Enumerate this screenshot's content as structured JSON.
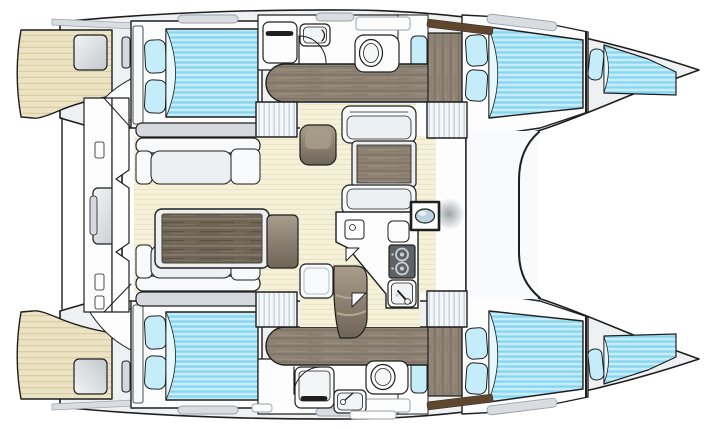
{
  "meta": {
    "type": "catamaran-floor-plan",
    "view": "top-down interior layout, bows to the right",
    "label": "Catamaran yacht interior floor plan"
  },
  "colors": {
    "background": "#ffffff",
    "outline": "#1f1f1f",
    "deck": "#eef0f2",
    "foredeck": "#f8fafb",
    "room": "#fdfdfe",
    "teak": "#ebe3c3",
    "teak_line": "#d7cba1",
    "floor": "#f6f1d8",
    "floor_line": "#e9e2c6",
    "bed_base": "#c8edfa",
    "bed_stripe": "#85d6ef",
    "bed_fold": "#e7f8fd",
    "pillow": "#c4ecf9",
    "wood_dark": "#6f6557",
    "wood_mid": "#8d8273",
    "wood_light": "#a99d8c",
    "cushion": "#d5d9dd",
    "cushion_light": "#edf0f2",
    "furniture": "#f7f9fa",
    "table_frame": "#eceef0",
    "steps_bg": "#f4f7fa",
    "steps_line": "#c3cdd8",
    "stove": "#5d6266",
    "burner_ring": "#c9ced2",
    "sink": "#bad2e0",
    "hatch": "#d9dde1",
    "rail": "#5e462f",
    "mast": "#8d9297",
    "gray_block_hi": "#f2f4f5",
    "gray_block_lo": "#c3c8cd"
  },
  "parts": {
    "hulls": [
      "port-hull",
      "starboard-hull"
    ],
    "cabins": [
      "port-aft-cabin",
      "port-forward-cabin",
      "port-forepeak-berth",
      "starboard-aft-cabin",
      "starboard-forward-cabin",
      "starboard-forepeak-berth"
    ],
    "wet_areas": [
      "port-head",
      "starboard-head"
    ],
    "living": [
      "salon-sofas",
      "salon-table",
      "forward-dinette",
      "galley"
    ],
    "aft": [
      "cockpit",
      "port-transom-deck",
      "starboard-transom-deck"
    ],
    "misc": [
      "companionway-steps",
      "deck-hatches",
      "mast",
      "handrails"
    ]
  }
}
